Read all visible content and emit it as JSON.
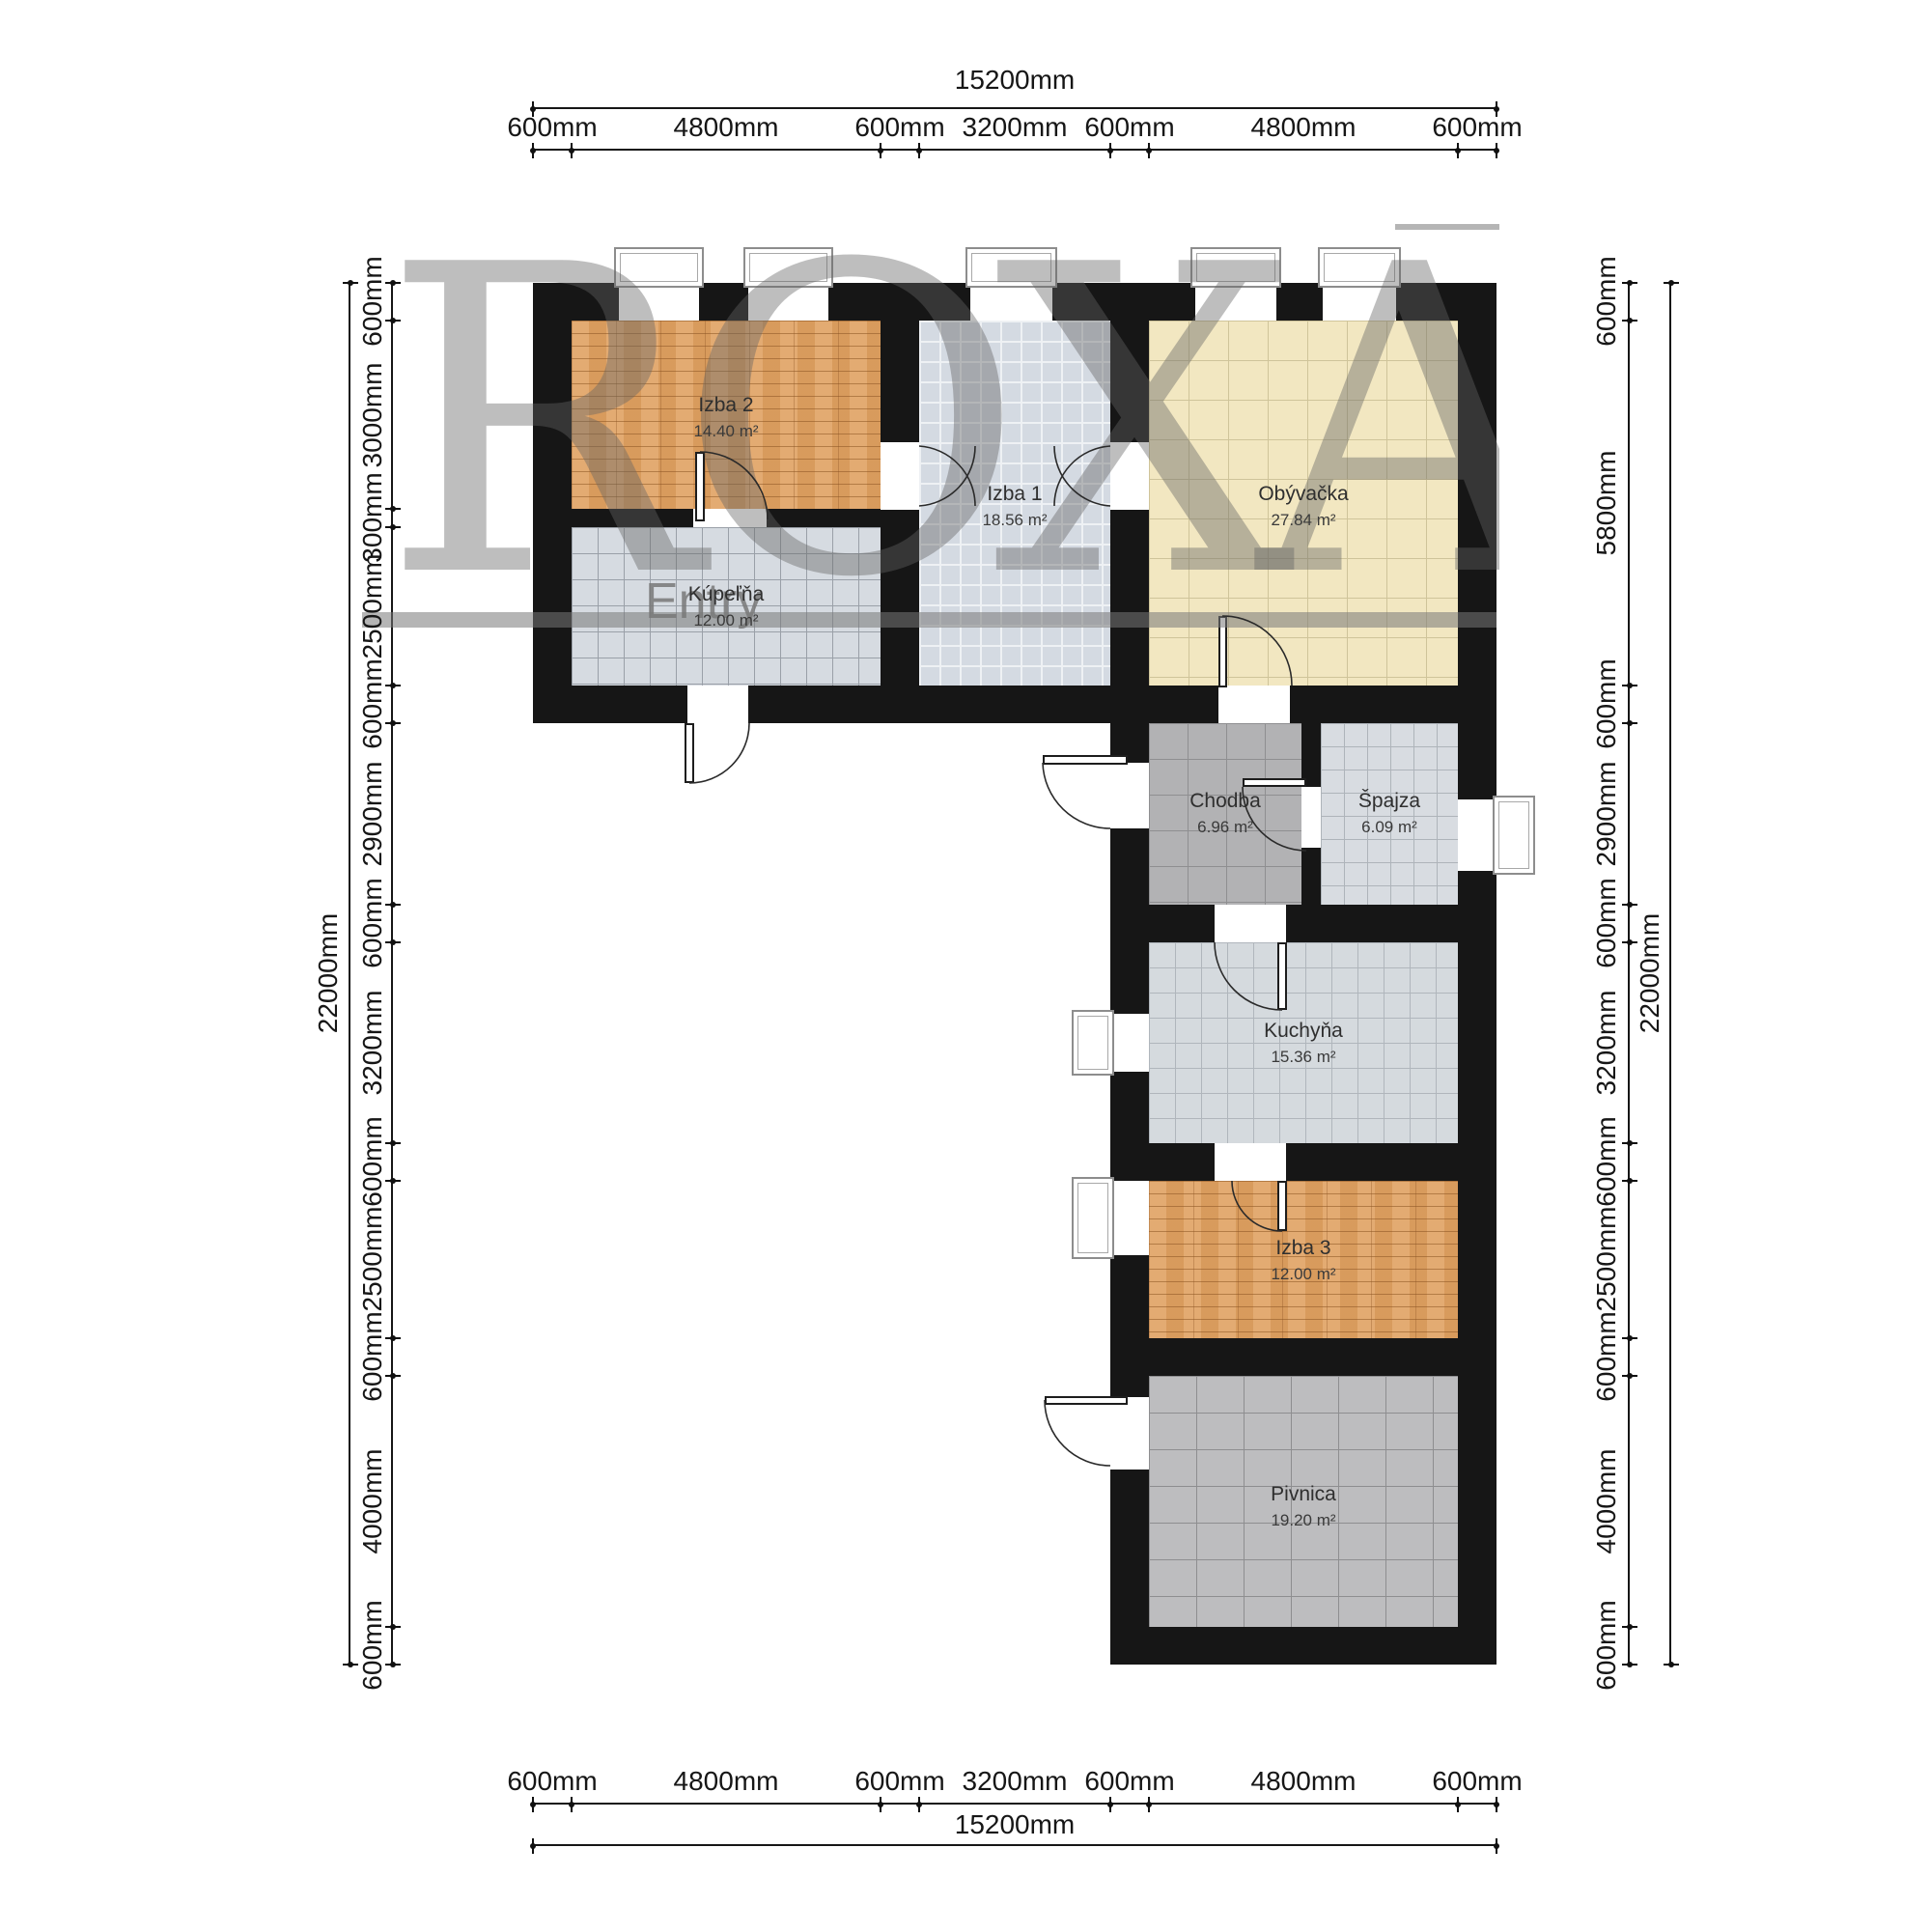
{
  "watermark": {
    "text": "ROXAN",
    "entry": "Entry"
  },
  "rooms": [
    {
      "id": "izba2",
      "name": "Izba 2",
      "area": "14.40 m²"
    },
    {
      "id": "kupelna",
      "name": "Kúpeľňa",
      "area": "12.00 m²"
    },
    {
      "id": "izba1",
      "name": "Izba 1",
      "area": "18.56 m²"
    },
    {
      "id": "obyvacka",
      "name": "Obývačka",
      "area": "27.84 m²"
    },
    {
      "id": "chodba",
      "name": "Chodba",
      "area": "6.96 m²"
    },
    {
      "id": "spajza",
      "name": "Špajza",
      "area": "6.09 m²"
    },
    {
      "id": "kuchyna",
      "name": "Kuchyňa",
      "area": "15.36 m²"
    },
    {
      "id": "izba3",
      "name": "Izba 3",
      "area": "12.00 m²"
    },
    {
      "id": "pivnica",
      "name": "Pivnica",
      "area": "19.20 m²"
    }
  ],
  "dimensions": {
    "top": {
      "total": "15200mm",
      "segments": [
        "600mm",
        "4800mm",
        "600mm",
        "3200mm",
        "600mm",
        "4800mm",
        "600mm"
      ]
    },
    "bottom": {
      "total": "15200mm",
      "segments": [
        "600mm",
        "4800mm",
        "600mm",
        "3200mm",
        "600mm",
        "4800mm",
        "600mm"
      ]
    },
    "left": {
      "total": "22000mm",
      "segments": [
        "600mm",
        "3000mm",
        "300mm",
        "2500mm",
        "600mm",
        "2900mm",
        "600mm",
        "3200mm",
        "600mm",
        "2500mm",
        "600mm",
        "4000mm",
        "600mm"
      ]
    },
    "right": {
      "total": "22000mm",
      "segments": [
        "600mm",
        "5800mm",
        "600mm",
        "2900mm",
        "600mm",
        "3200mm",
        "600mm",
        "2500mm",
        "600mm",
        "4000mm",
        "600mm"
      ]
    }
  },
  "colors": {
    "wall": "#161616",
    "wood": "#e0a262",
    "tile_light": "#d6dbe1",
    "tile_yellow": "#f2e7c1",
    "tile_gray": "#b2b2b4",
    "tile_dark": "#bdbdbf"
  }
}
